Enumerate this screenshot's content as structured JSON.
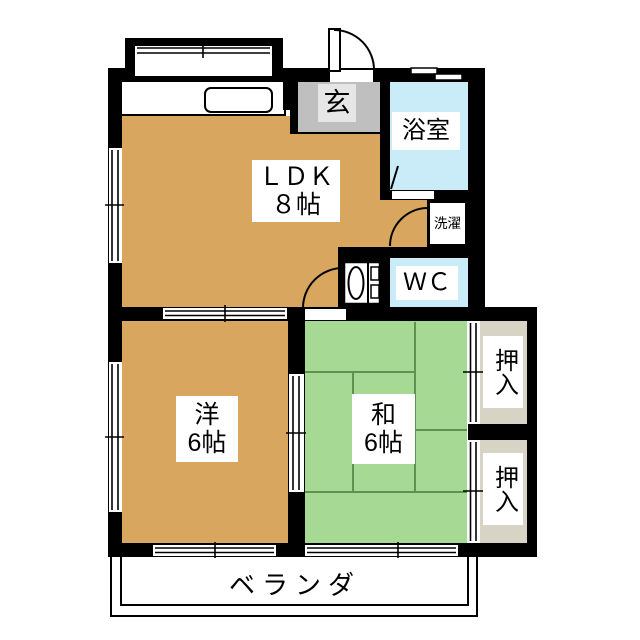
{
  "plan_title": "apartment-floorplan-2dk",
  "rooms": {
    "ldk": {
      "name": "ＬＤＫ",
      "size": "８帖"
    },
    "western": {
      "name": "洋",
      "size": "6帖"
    },
    "japanese": {
      "name": "和",
      "size": "6帖"
    },
    "bathroom": {
      "name": "浴室"
    },
    "toilet": {
      "name": "ＷＣ"
    },
    "entrance": {
      "name": "玄"
    },
    "laundry": {
      "name": "洗濯"
    },
    "closet_upper": {
      "name": "押入"
    },
    "closet_lower": {
      "name": "押入"
    },
    "veranda": {
      "name": "ベランダ"
    }
  },
  "colors": {
    "wall": "#000000",
    "wood_floor": "#D8A65E",
    "tatami_floor": "#A5D994",
    "tatami_line": "#5F9150",
    "water_area": "#C9ECF8",
    "entrance_floor": "#BFBFBF",
    "closet_floor": "#D7D3C5",
    "background": "#FFFFFF"
  }
}
